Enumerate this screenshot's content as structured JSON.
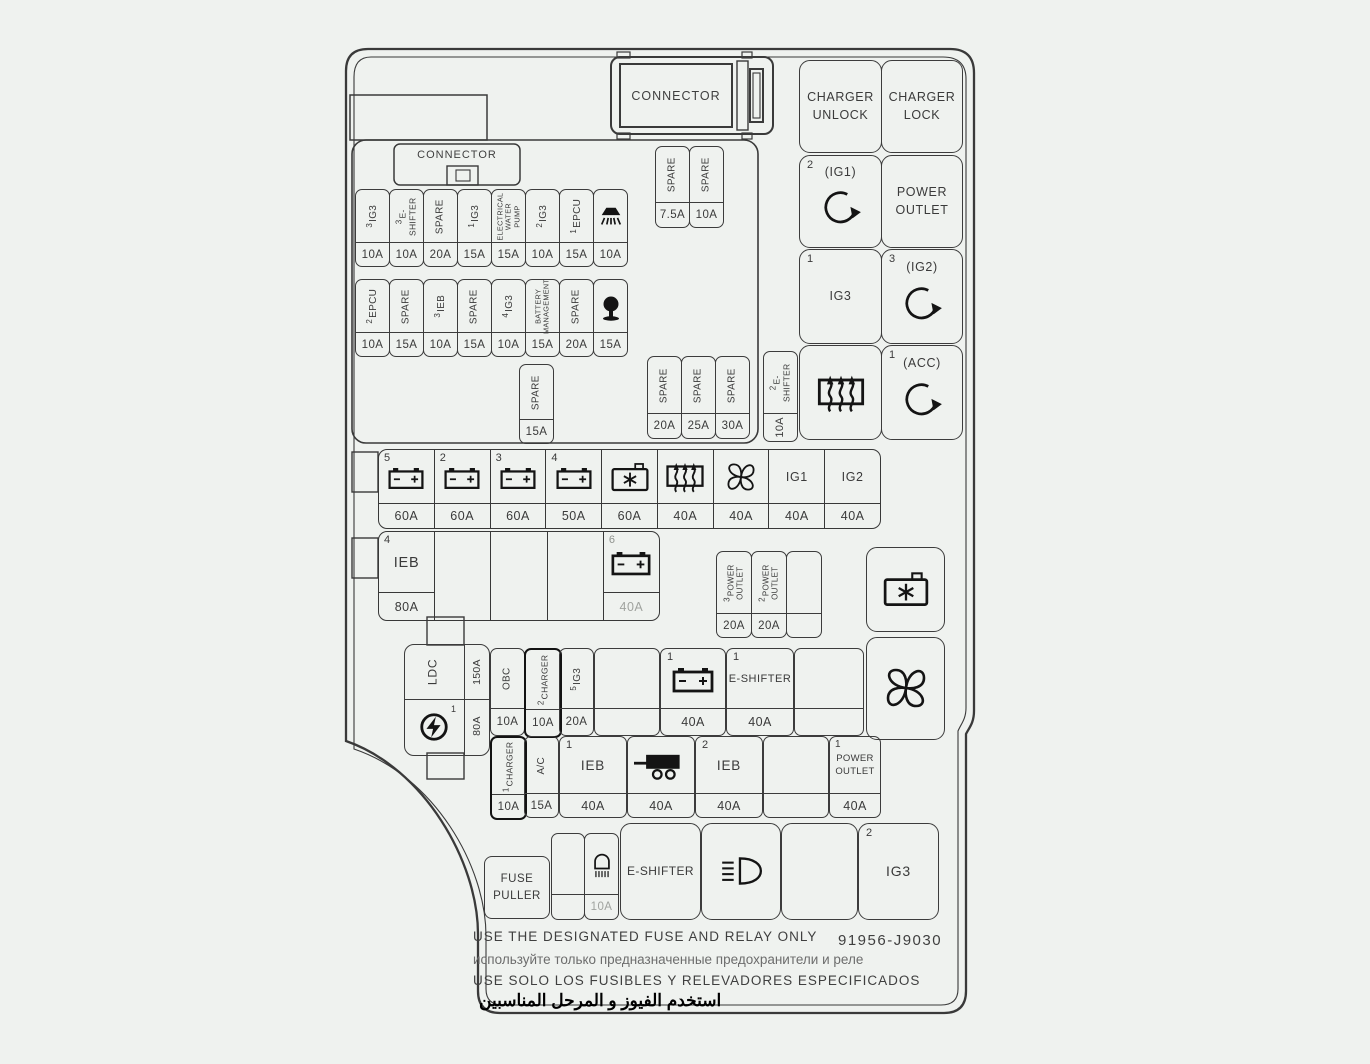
{
  "title": "Engine compartment fuse and relay box diagram",
  "connector_top": "CONNECTOR",
  "connector_inner": "CONNECTOR",
  "relays": {
    "charger_unlock": "CHARGER\nUNLOCK",
    "charger_lock": "CHARGER\nLOCK",
    "ig1": {
      "num": "2",
      "label": "(IG1)"
    },
    "power_outlet": "POWER\nOUTLET",
    "ig3": {
      "num": "1",
      "label": "IG3"
    },
    "ig2": {
      "num": "3",
      "label": "(IG2)"
    },
    "acc": {
      "num": "1",
      "label": "(ACC)"
    },
    "ig3_bottom": {
      "num": "2",
      "label": "IG3"
    },
    "eshifter": "E-SHIFTER"
  },
  "fuse_row_1": [
    {
      "num": "3",
      "label": "IG3",
      "amp": "10A"
    },
    {
      "num": "3",
      "label": "E-SHIFTER",
      "amp": "10A"
    },
    {
      "num": "",
      "label": "SPARE",
      "amp": "20A"
    },
    {
      "num": "1",
      "label": "IG3",
      "amp": "15A"
    },
    {
      "num": "",
      "label": "ELECTRICAL\nWATER PUMP",
      "amp": "15A"
    },
    {
      "num": "2",
      "label": "IG3",
      "amp": "10A"
    },
    {
      "num": "1",
      "label": "EPCU",
      "amp": "15A"
    },
    {
      "num": "",
      "label": "",
      "icon": "washer",
      "amp": "10A"
    }
  ],
  "fuse_row_2": [
    {
      "num": "2",
      "label": "EPCU",
      "amp": "10A"
    },
    {
      "num": "",
      "label": "SPARE",
      "amp": "15A"
    },
    {
      "num": "3",
      "label": "IEB",
      "amp": "10A"
    },
    {
      "num": "",
      "label": "SPARE",
      "amp": "15A"
    },
    {
      "num": "4",
      "label": "IG3",
      "amp": "10A"
    },
    {
      "num": "",
      "label": "BATTERY\nMANAGEMENT",
      "amp": "15A"
    },
    {
      "num": "",
      "label": "SPARE",
      "amp": "20A"
    },
    {
      "num": "",
      "label": "",
      "icon": "horn",
      "amp": "15A"
    }
  ],
  "spare_fuses": {
    "s15": {
      "label": "SPARE",
      "amp": "15A"
    },
    "s75": {
      "label": "SPARE",
      "amp": "7.5A"
    },
    "s10": {
      "label": "SPARE",
      "amp": "10A"
    },
    "s20": {
      "label": "SPARE",
      "amp": "20A"
    },
    "s25": {
      "label": "SPARE",
      "amp": "25A"
    },
    "s30": {
      "label": "SPARE",
      "amp": "30A"
    }
  },
  "eshifter_fuse": {
    "num": "2",
    "label": "E-SHIFTER",
    "amp": "10A"
  },
  "main_row": [
    {
      "num": "5",
      "icon": "battery",
      "amp": "60A"
    },
    {
      "num": "2",
      "icon": "battery",
      "amp": "60A"
    },
    {
      "num": "3",
      "icon": "battery",
      "amp": "60A"
    },
    {
      "num": "4",
      "icon": "battery",
      "amp": "50A"
    },
    {
      "num": "",
      "icon": "compressor",
      "amp": "60A"
    },
    {
      "num": "",
      "icon": "defroster",
      "amp": "40A"
    },
    {
      "num": "",
      "icon": "fan",
      "amp": "40A"
    },
    {
      "num": "",
      "label": "IG1",
      "amp": "40A"
    },
    {
      "num": "",
      "label": "IG2",
      "amp": "40A"
    }
  ],
  "ieb_row": {
    "ieb": {
      "num": "4",
      "label": "IEB",
      "amp": "80A"
    },
    "battery": {
      "num": "6",
      "amp": "40A"
    }
  },
  "po_fuses": [
    {
      "num": "3",
      "label": "POWER\nOUTLET",
      "amp": "20A"
    },
    {
      "num": "2",
      "label": "POWER\nOUTLET",
      "amp": "20A"
    }
  ],
  "ldc": {
    "label": "LDC",
    "amp_top": "150A",
    "num": "1",
    "amp_bottom": "80A"
  },
  "obc_row": {
    "obc": {
      "label": "OBC",
      "amp": "10A"
    },
    "charger": {
      "num": "2",
      "label": "CHARGER",
      "amp": "10A"
    },
    "ig3": {
      "num": "5",
      "label": "IG3",
      "amp": "20A"
    },
    "battery": {
      "num": "1",
      "amp": "40A"
    },
    "eshifter": {
      "num": "1",
      "label": "E-SHIFTER",
      "amp": "40A"
    }
  },
  "charger_row": {
    "charger": {
      "num": "1",
      "label": "CHARGER",
      "amp": "10A"
    },
    "ac": {
      "label": "A/C",
      "amp": "15A"
    },
    "ieb1": {
      "num": "1",
      "label": "IEB",
      "amp": "40A"
    },
    "trailer": {
      "amp": "40A"
    },
    "ieb2": {
      "num": "2",
      "label": "IEB",
      "amp": "40A"
    },
    "power_outlet": {
      "num": "1",
      "label": "POWER\nOUTLET",
      "amp": "40A"
    }
  },
  "bottom_row": {
    "fuse_puller": "FUSE\nPULLER",
    "lamp": {
      "amp": "10A"
    }
  },
  "footer": {
    "line_en": "USE THE DESIGNATED FUSE AND RELAY ONLY",
    "part_number": "91956-J9030",
    "line_ru": "используйте только предназначенные предохранители и реле",
    "line_es": "USE SOLO LOS FUSIBLES Y RELEVADORES ESPECIFICADOS",
    "line_ar": "استخدم الفيوز و المرحل المناسبين"
  },
  "colors": {
    "line": "#3c3c3c",
    "muted_amp": "#a0a39f",
    "ru_text": "#6d6d6d"
  }
}
